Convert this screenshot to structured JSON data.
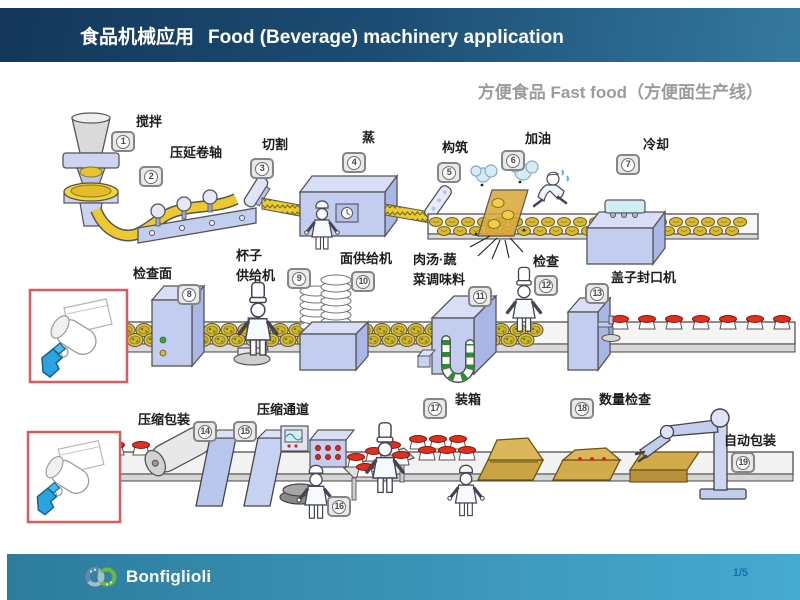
{
  "header": {
    "title_zh": "食品机械应用",
    "title_en": "Food (Beverage) machinery application"
  },
  "subtitle": "方便食品 Fast food（方便面生产线）",
  "stations": [
    {
      "num": "1",
      "label": "搅拌"
    },
    {
      "num": "2",
      "label": "压延卷轴"
    },
    {
      "num": "3",
      "label": "切割"
    },
    {
      "num": "4",
      "label": "蒸"
    },
    {
      "num": "5",
      "label": "构筑"
    },
    {
      "num": "6",
      "label": "加油"
    },
    {
      "num": "7",
      "label": "冷却"
    },
    {
      "num": "8",
      "label": "检查面"
    },
    {
      "num": "9",
      "label": "杯子\n供给机"
    },
    {
      "num": "10",
      "label": "面供给机"
    },
    {
      "num": "11",
      "label": "肉汤·蔬\n菜调味料"
    },
    {
      "num": "12",
      "label": "检查"
    },
    {
      "num": "13",
      "label": "盖子封口机"
    },
    {
      "num": "14",
      "label": "压缩包装"
    },
    {
      "num": "15",
      "label": "压缩通道"
    },
    {
      "num": "16",
      "label": ""
    },
    {
      "num": "17",
      "label": "装箱"
    },
    {
      "num": "18",
      "label": "数量检查"
    },
    {
      "num": "19",
      "label": "自动包装"
    }
  ],
  "diagram": {
    "description": "Instant noodle production line diagram with 19 numbered stations on three conveyor rows, plus two red-framed gearmotor insets"
  },
  "footer": {
    "brand": "Bonfiglioli",
    "page": "1/5"
  },
  "icons": {
    "logo": "interlocking-rings-icon"
  },
  "colors": {
    "header_gradient_from": "#14375a",
    "header_gradient_to": "#35799f",
    "footer_gradient_from": "#2d7c9c",
    "footer_gradient_to": "#47aad0",
    "page_number": "#1a6fae",
    "badge_gray": "#e9e9e9",
    "machine_blue": "#c3cdf0",
    "noodle_yellow": "#e9cb36",
    "lid_red": "#e03020",
    "carton_tan": "#d2ab4a",
    "inset_border_red": "#d95b5b",
    "logo_green": "#6cb83d"
  }
}
